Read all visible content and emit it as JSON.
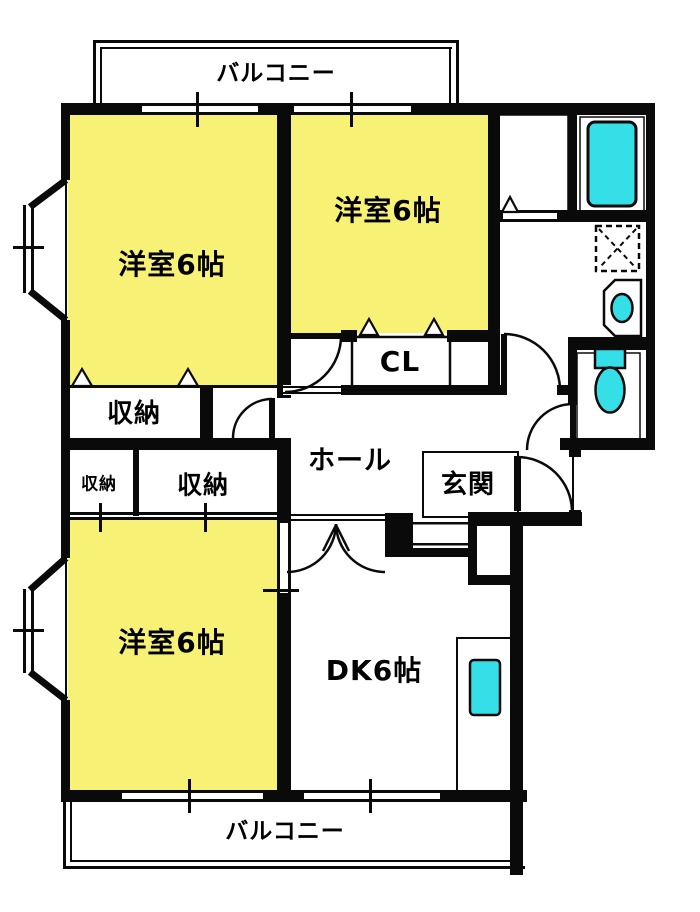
{
  "plan": {
    "type": "apartment-floor-plan",
    "labels": {
      "balcony_top": "バルコニー",
      "bedroom_top_left": "洋室6帖",
      "bedroom_top_middle": "洋室6帖",
      "bedroom_bottom_left": "洋室6帖",
      "dining_kitchen": "DK6帖",
      "closet": "CL",
      "hall": "ホール",
      "entrance": "玄関",
      "storage_main": "収納",
      "storage_small": "収納",
      "storage_mid": "収納",
      "balcony_bottom": "バルコニー"
    },
    "fixtures": [
      "bathtub",
      "washing-machine-pan",
      "wash-basin",
      "toilet",
      "kitchen-sink",
      "bay-window",
      "bay-window"
    ],
    "colors": {
      "room_fill": "#F7F175",
      "fixture_fill": "#35DFE8",
      "wall": "#0A0A0A",
      "background": "#FFFFFF"
    }
  }
}
